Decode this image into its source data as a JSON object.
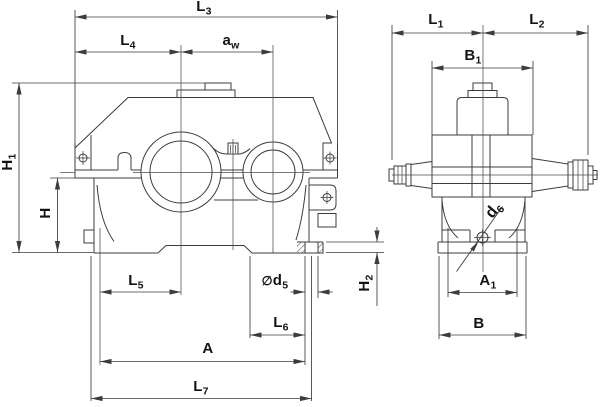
{
  "drawing": {
    "type": "technical-dimension-drawing",
    "views": [
      {
        "id": "front-view",
        "position": "left"
      },
      {
        "id": "side-view",
        "position": "right"
      }
    ],
    "colors": {
      "line": "#3c3c3c",
      "dimension": "#4d4d4d",
      "text": "#141414",
      "background": "#ffffff"
    }
  },
  "labels": {
    "L3": {
      "base": "L",
      "sub": "3"
    },
    "L4": {
      "base": "L",
      "sub": "4"
    },
    "aw": {
      "base": "a",
      "sub": "w"
    },
    "H1": {
      "base": "H",
      "sub": "1"
    },
    "H": {
      "base": "H",
      "sub": ""
    },
    "L5": {
      "base": "L",
      "sub": "5"
    },
    "d5": {
      "prefix": "∅",
      "base": "d",
      "sub": "5"
    },
    "L6": {
      "base": "L",
      "sub": "6"
    },
    "A": {
      "base": "A",
      "sub": ""
    },
    "L7": {
      "base": "L",
      "sub": "7"
    },
    "H2": {
      "base": "H",
      "sub": "2"
    },
    "L1": {
      "base": "L",
      "sub": "1"
    },
    "L2": {
      "base": "L",
      "sub": "2"
    },
    "B1": {
      "base": "B",
      "sub": "1"
    },
    "d6": {
      "base": "d",
      "sub": "6"
    },
    "A1": {
      "base": "A",
      "sub": "1"
    },
    "B": {
      "base": "B",
      "sub": ""
    }
  }
}
